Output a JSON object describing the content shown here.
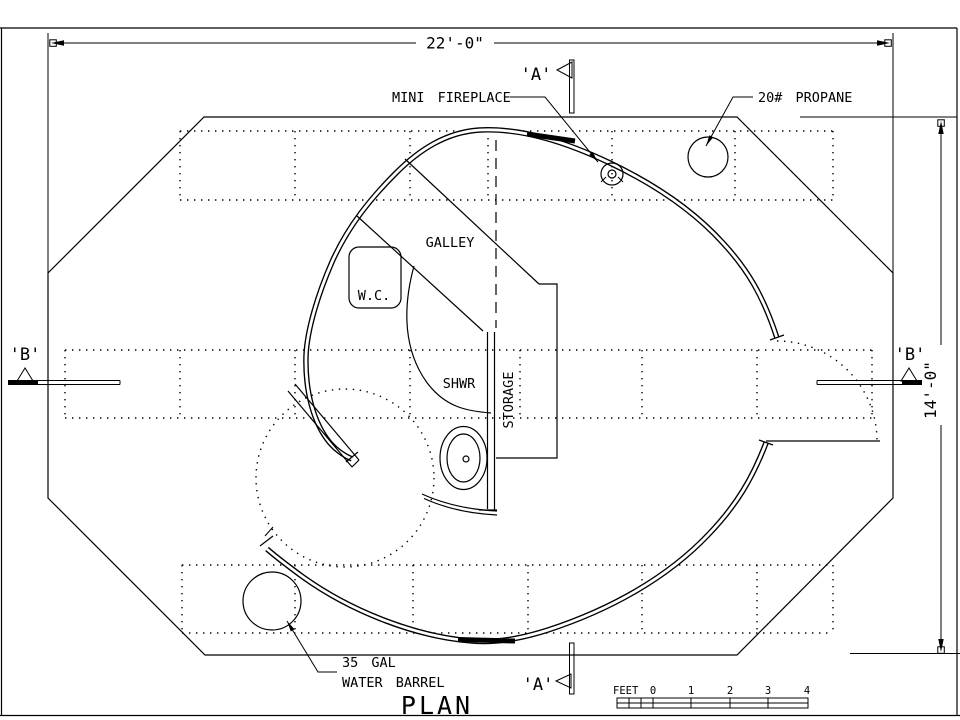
{
  "drawing": {
    "title": "PLAN",
    "dimensions": {
      "width": "22'-0\"",
      "height": "14'-0\""
    },
    "sections": {
      "a": "'A'",
      "b": "'B'"
    },
    "labels": {
      "fireplace": "MINI FIREPLACE",
      "propane": "20# PROPANE",
      "galley": "GALLEY",
      "wc": "W.C.",
      "shower": "SHWR",
      "storage": "STORAGE",
      "barrel_line1": "35 GAL",
      "barrel_line2": "WATER BARREL"
    },
    "scale_bar": {
      "unit": "FEET",
      "ticks": [
        "0",
        "1",
        "2",
        "3",
        "4"
      ]
    },
    "colors": {
      "ink": "#000000",
      "paper": "#ffffff"
    }
  }
}
